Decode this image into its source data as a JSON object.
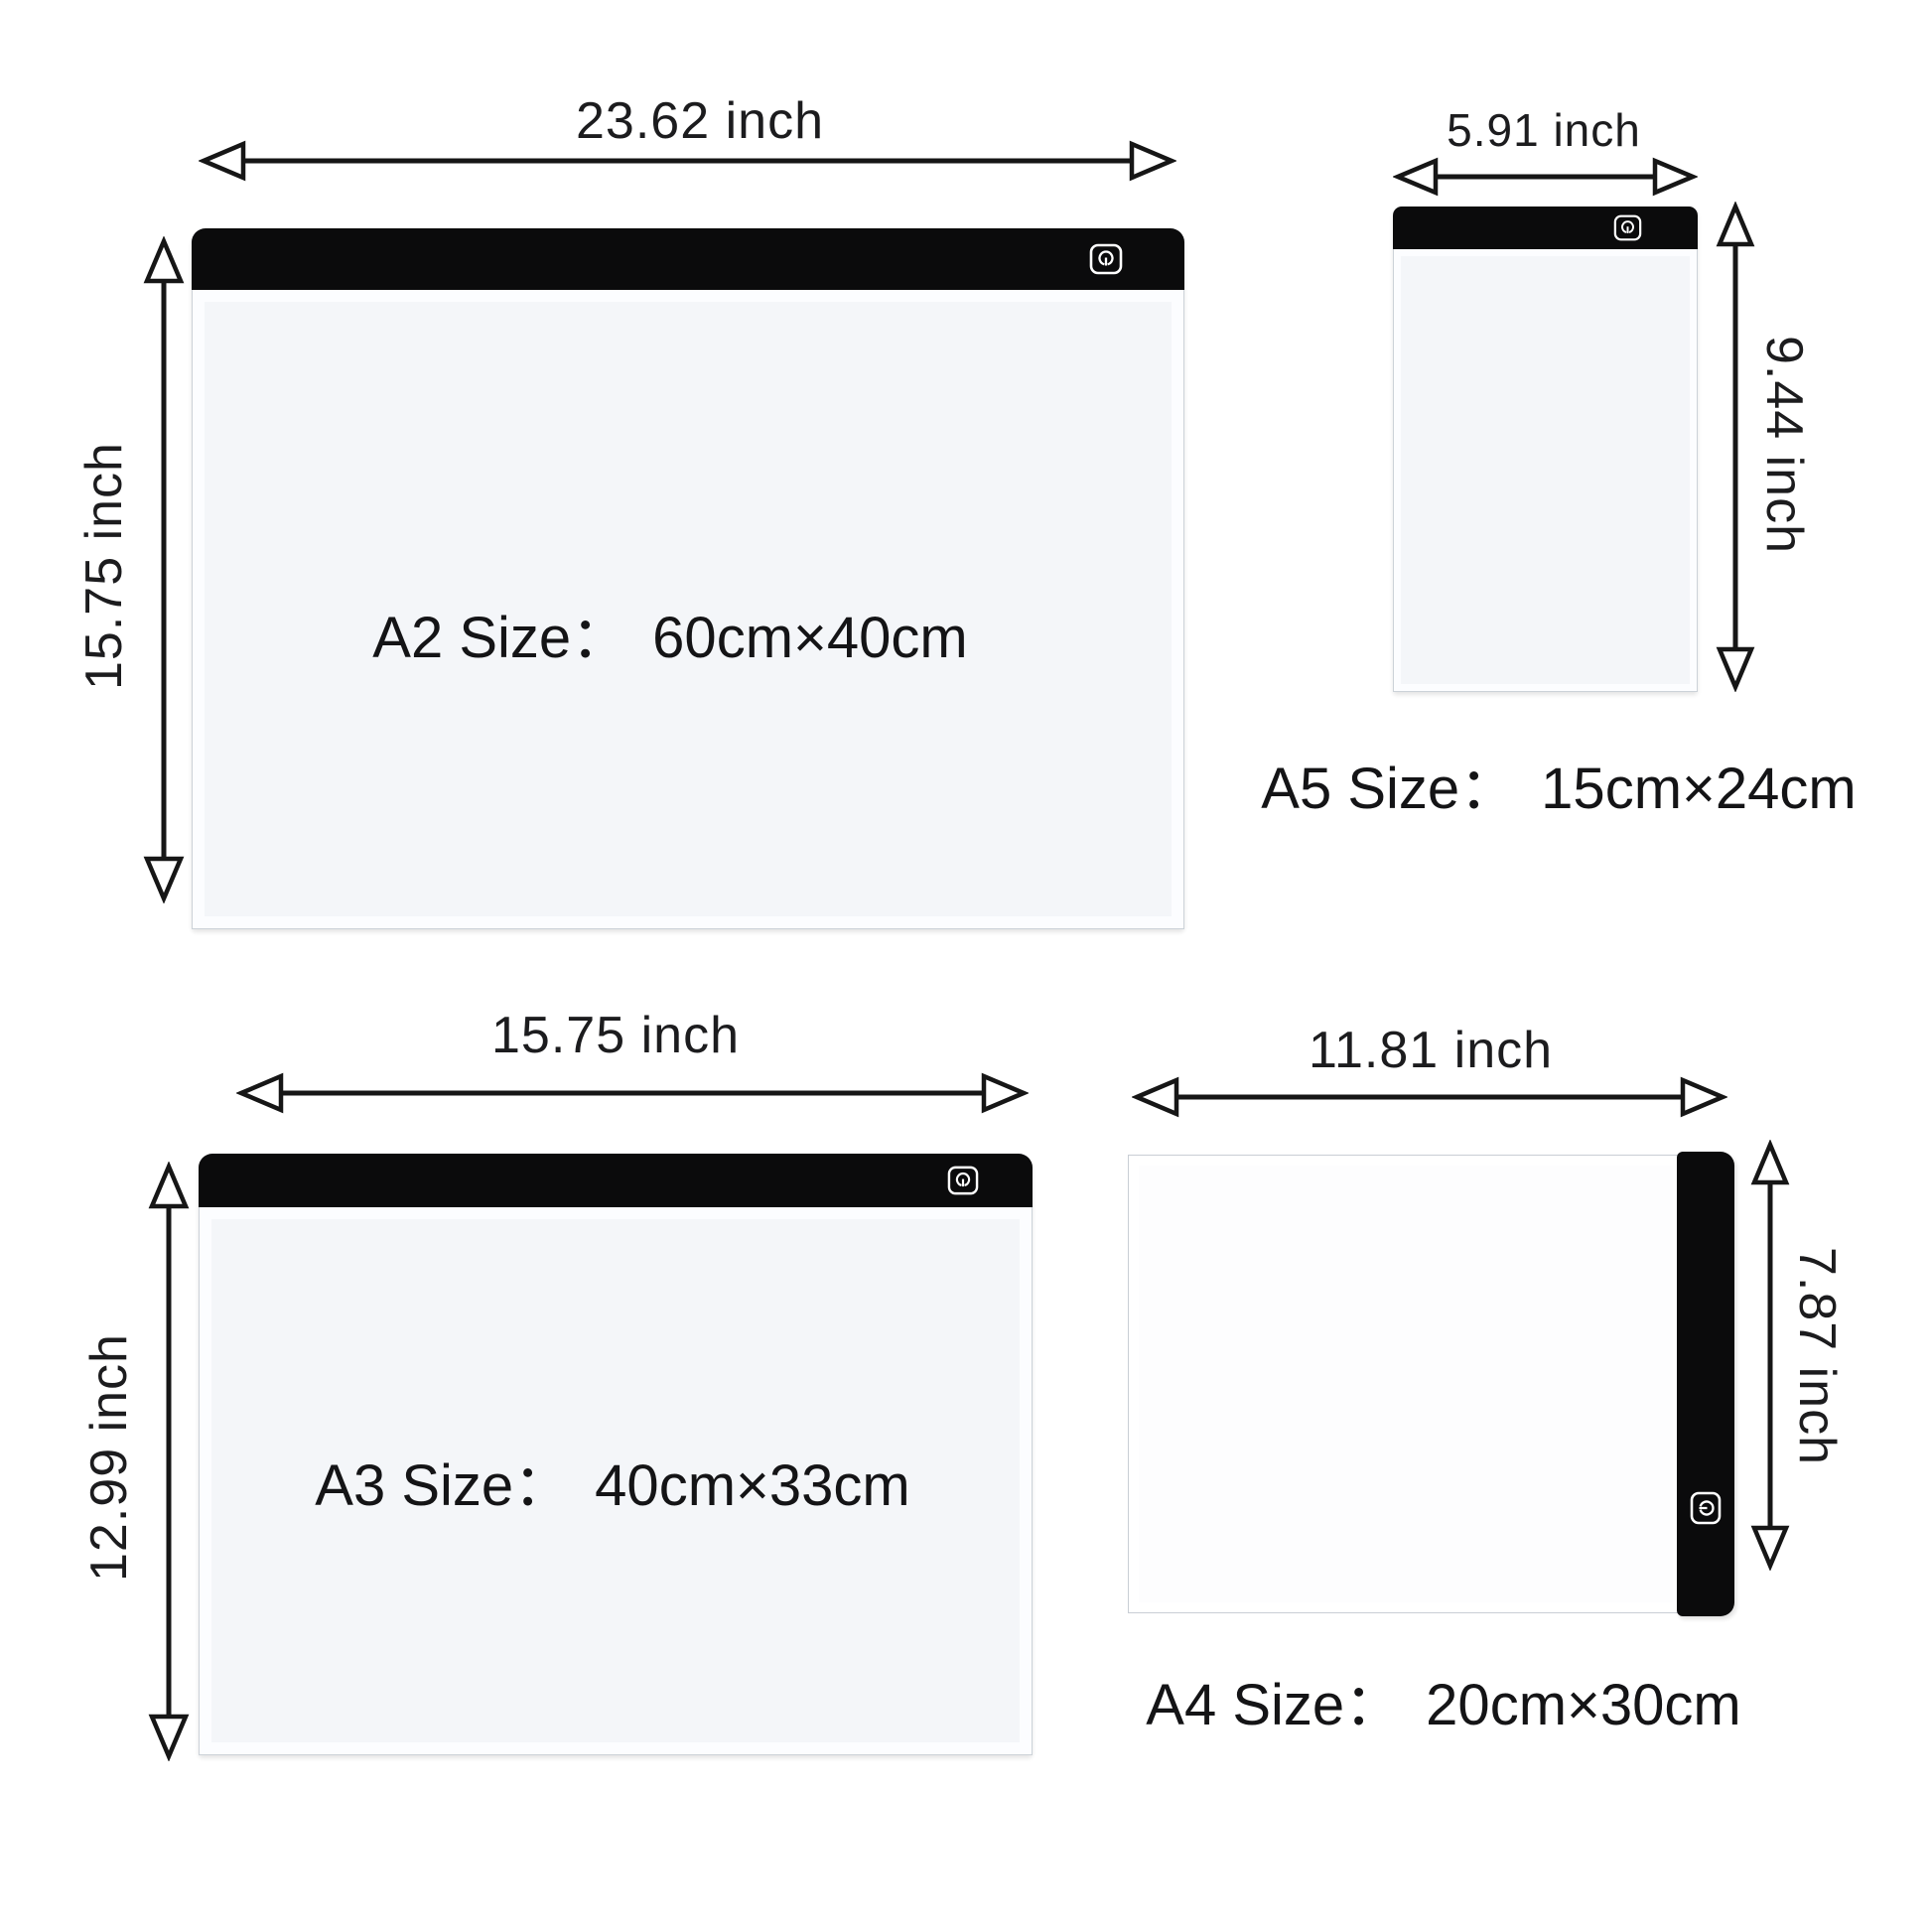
{
  "colors": {
    "background": "#ffffff",
    "text": "#1c1c1e",
    "arrow": "#161616",
    "bar": "#0b0b0c",
    "pad_body": "#f4f6f9",
    "pad_border": "#ccd2d8",
    "power_icon": "#ffffff"
  },
  "panels": {
    "a2": {
      "name": "A2",
      "size_label": "A2 Size：",
      "size_value": "60cm×40cm",
      "width_label": "23.62 inch",
      "height_label": "15.75 inch"
    },
    "a5": {
      "name": "A5",
      "size_label": "A5 Size：",
      "size_value": "15cm×24cm",
      "width_label": "5.91 inch",
      "height_label": "9.44 inch"
    },
    "a3": {
      "name": "A3",
      "size_label": "A3 Size：",
      "size_value": "40cm×33cm",
      "width_label": "15.75 inch",
      "height_label": "12.99 inch"
    },
    "a4": {
      "name": "A4",
      "size_label": "A4 Size：",
      "size_value": "20cm×30cm",
      "width_label": "11.81 inch",
      "height_label": "7.87 inch"
    }
  },
  "icons": {
    "power": "power-icon"
  }
}
